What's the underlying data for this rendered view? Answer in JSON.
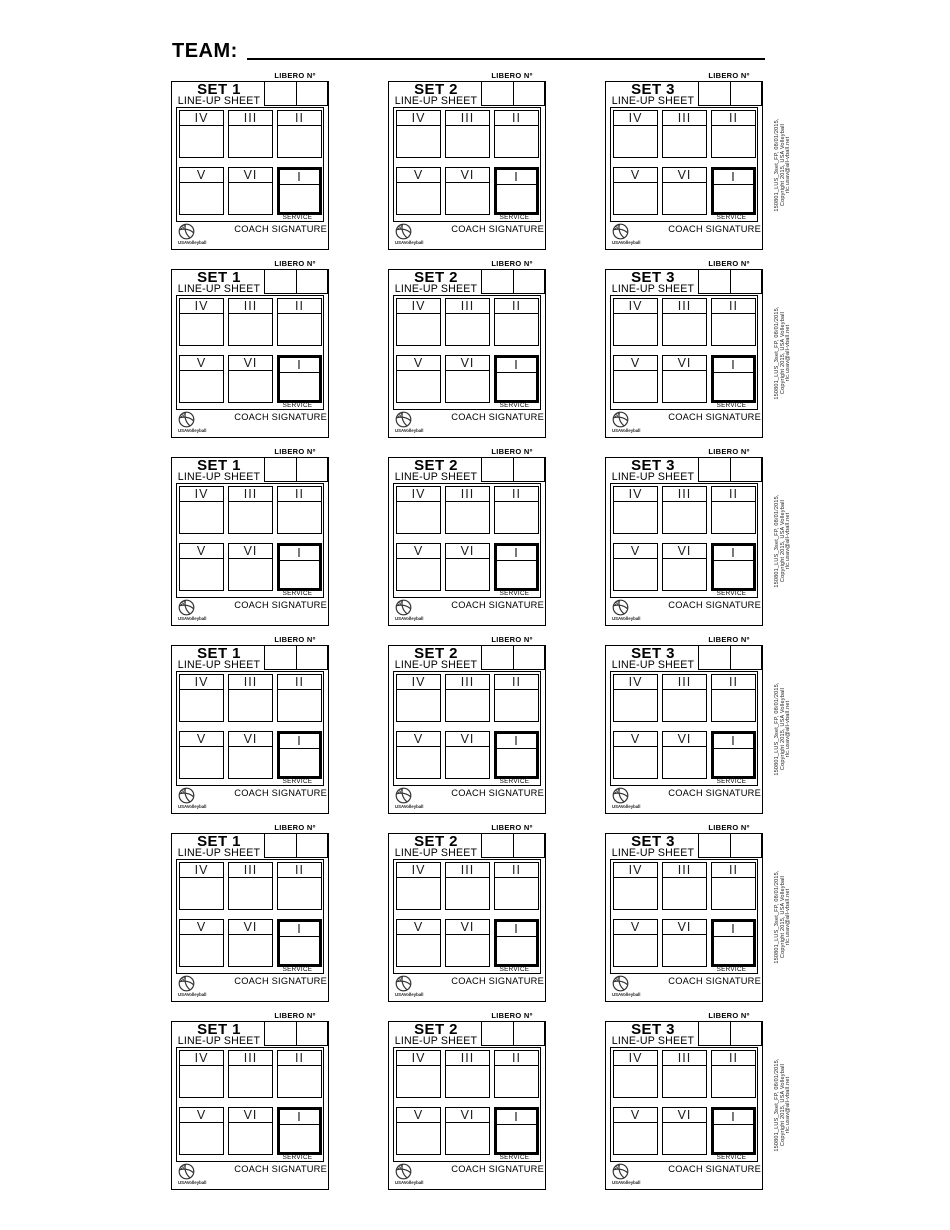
{
  "header": {
    "team_label": "TEAM:"
  },
  "sets": [
    "SET 1",
    "SET 2",
    "SET 3"
  ],
  "grid": {
    "rows": 6,
    "columns": 3
  },
  "card": {
    "libero_label": "LIBERO Nº",
    "lineup_sheet_label": "LINE-UP SHEET",
    "positions_top": [
      "IV",
      "III",
      "II"
    ],
    "positions_bottom": [
      "V",
      "VI",
      "I"
    ],
    "service_label": "SERVICE",
    "coach_signature_label": "COACH SIGNATURE",
    "logo_text": "USAVolleyball",
    "ink_color": "#000000",
    "service_border_color": "#000000"
  },
  "side_note": {
    "line1": "150801_LUS_3set_FP, 08/01/2015,",
    "line2": "Copyright 2015, USA Volleyball",
    "line3": "rlc.usav@all-vball.net"
  }
}
